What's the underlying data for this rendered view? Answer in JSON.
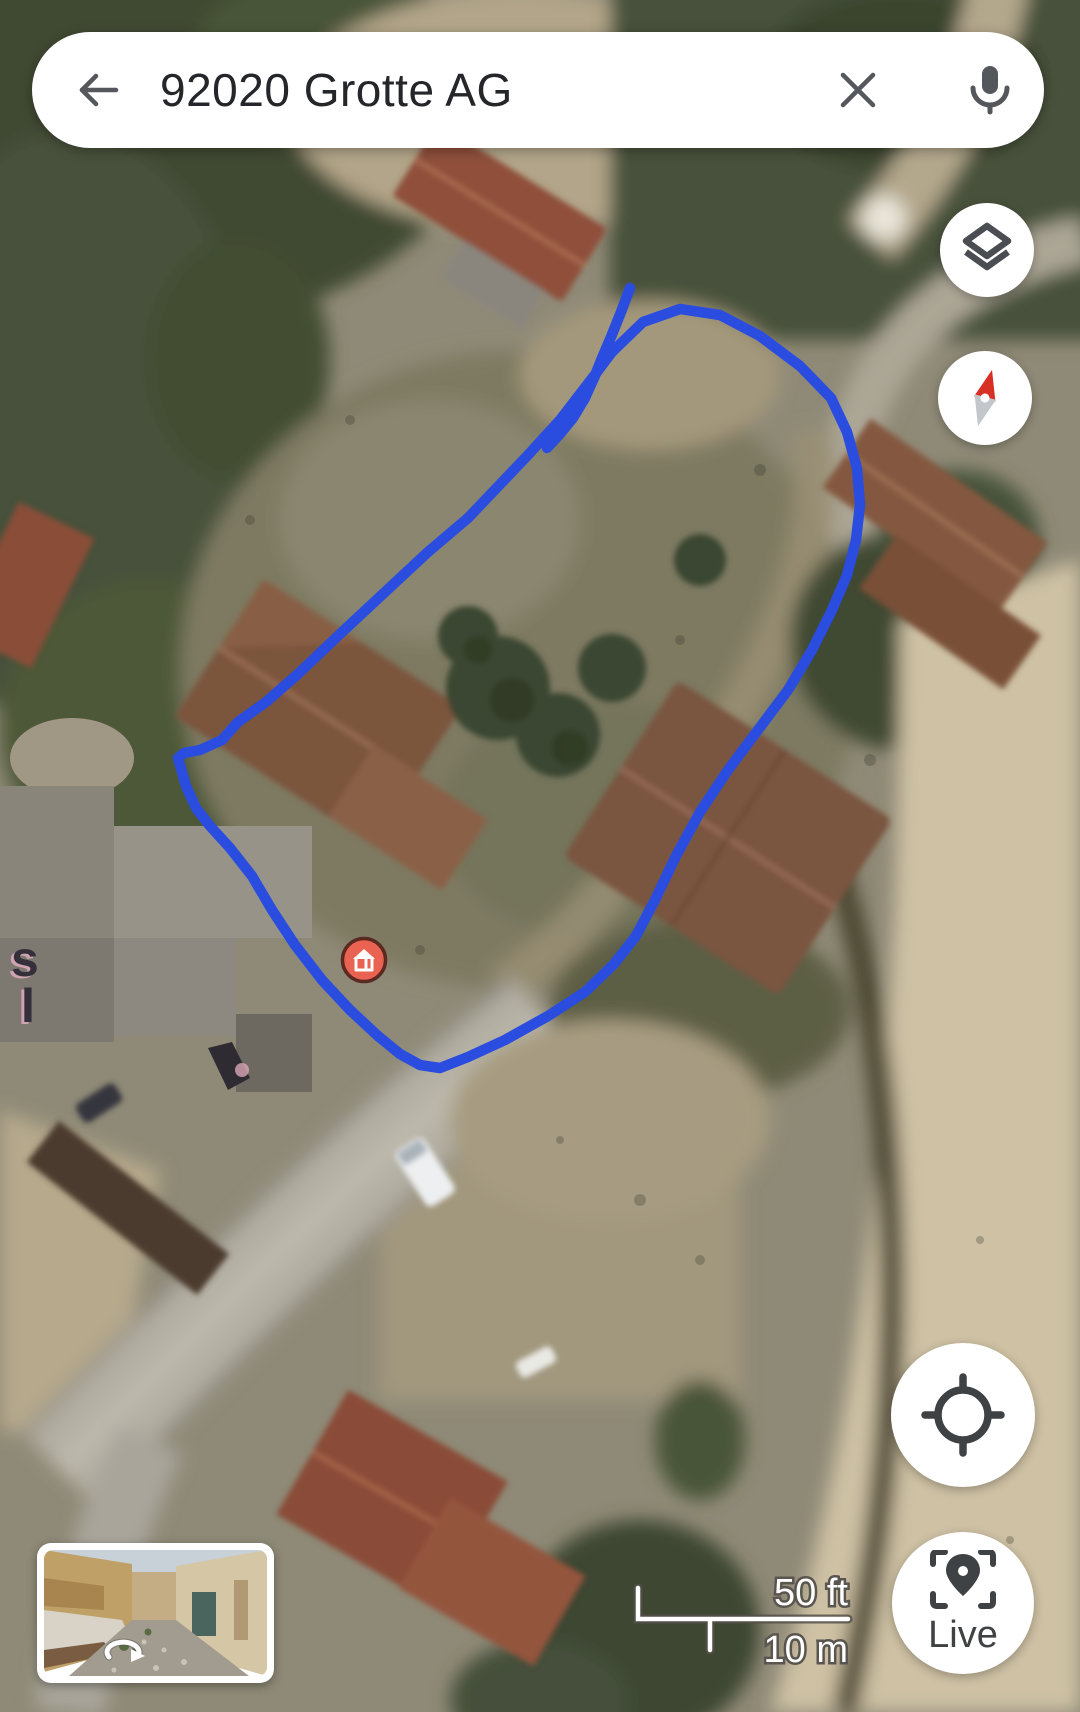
{
  "search_bar": {
    "query": "92020 Grotte AG"
  },
  "controls": {
    "live_label": "Live"
  },
  "scale_bar": {
    "imperial": "50 ft",
    "metric": "10 m"
  },
  "annotation": {
    "stroke_color": "#2a4de0"
  },
  "marker": {
    "fill_color": "#ea6352",
    "outline_color": "#5a2a20"
  },
  "compass": {
    "north_color": "#d93025",
    "south_color": "#c3c7cb"
  },
  "map_label_fragments": {
    "line1": "s",
    "line2": "I"
  },
  "icons": {
    "back": "arrow-left",
    "clear": "close-x",
    "mic": "microphone",
    "layers": "map-layers",
    "compass": "compass-needle",
    "my_location": "crosshair",
    "live": "ar-location-pin",
    "street_view": "rotate-arrow",
    "marker": "house"
  }
}
